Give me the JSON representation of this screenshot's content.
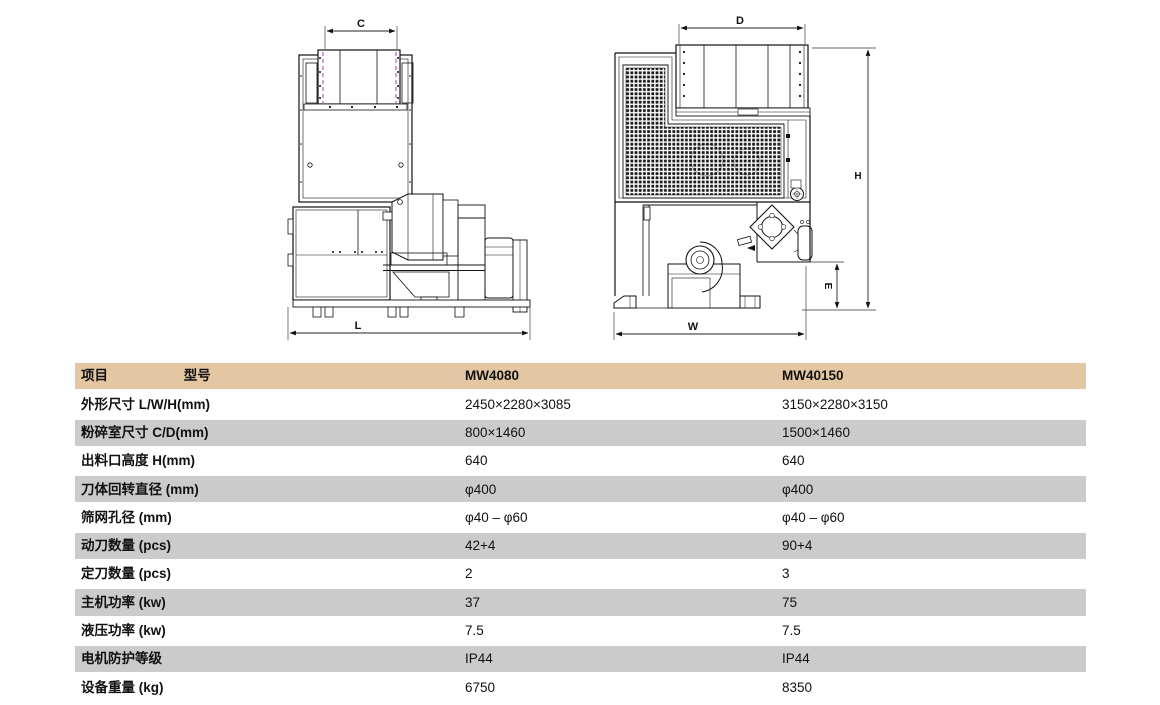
{
  "diagrams": {
    "front_view": {
      "description": "granulator front elevation drawing",
      "dims": {
        "c": "C",
        "l": "L"
      }
    },
    "side_view": {
      "description": "granulator side elevation drawing",
      "dims": {
        "d": "D",
        "h": "H",
        "e": "E",
        "w": "W"
      }
    }
  },
  "table": {
    "colors": {
      "header_bg": "#e3c7a3",
      "alt_row_bg": "#cbcbcb"
    },
    "header": {
      "item": "项目",
      "model": "型号",
      "model1": "MW4080",
      "model2": "MW40150"
    },
    "rows": [
      {
        "label": "外形尺寸 L/W/H(mm)",
        "m1": "2450×2280×3085",
        "m2": "3150×2280×3150"
      },
      {
        "label": "粉碎室尺寸 C/D(mm)",
        "m1": "800×1460",
        "m2": "1500×1460"
      },
      {
        "label": "出料口高度 H(mm)",
        "m1": "640",
        "m2": "640"
      },
      {
        "label": "刀体回转直径 (mm)",
        "m1": "φ400",
        "m2": "φ400"
      },
      {
        "label": "筛网孔径 (mm)",
        "m1": "φ40 – φ60",
        "m2": "φ40 – φ60"
      },
      {
        "label": "动刀数量 (pcs)",
        "m1": "42+4",
        "m2": "90+4"
      },
      {
        "label": "定刀数量 (pcs)",
        "m1": "2",
        "m2": "3"
      },
      {
        "label": "主机功率 (kw)",
        "m1": "37",
        "m2": "75"
      },
      {
        "label": "液压功率 (kw)",
        "m1": "7.5",
        "m2": "7.5"
      },
      {
        "label": "电机防护等级",
        "m1": "IP44",
        "m2": "IP44"
      },
      {
        "label": "设备重量 (kg)",
        "m1": "6750",
        "m2": "8350"
      }
    ]
  }
}
